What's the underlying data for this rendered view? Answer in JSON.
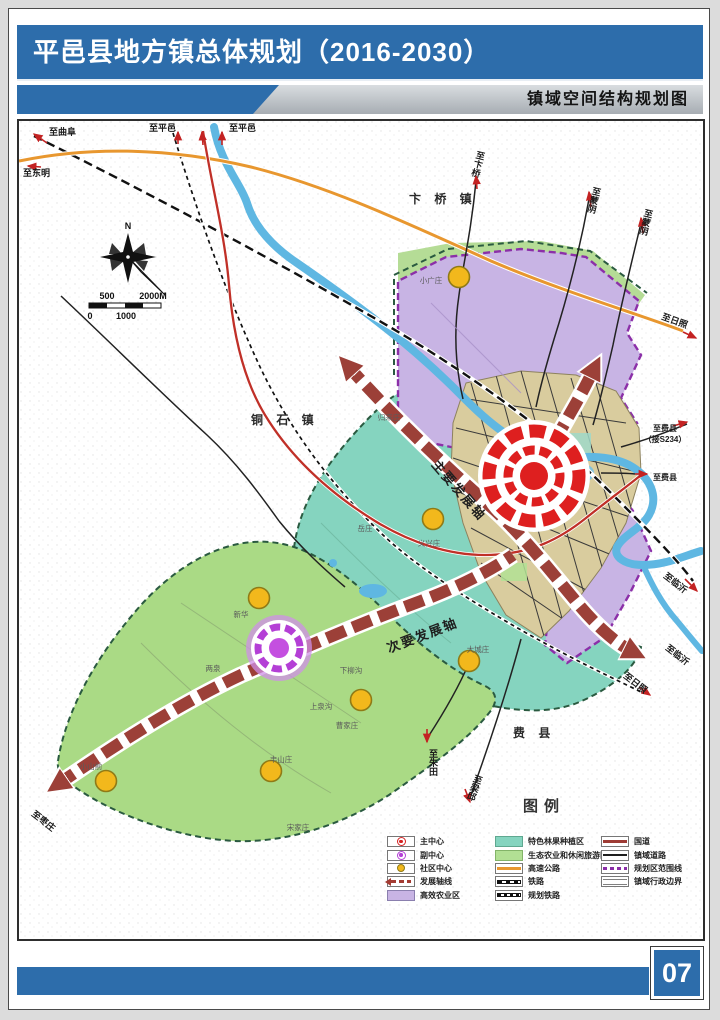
{
  "header": {
    "title": "平邑县地方镇总体规划（2016-2030）",
    "subtitle": "镇域空间结构规划图"
  },
  "map": {
    "region_labels": {
      "bianqiao": "卞 桥 镇",
      "tongshi": "铜 石 镇",
      "feixian": "费 县"
    },
    "axis_labels": {
      "main": "主要发展轴",
      "secondary": "次要发展轴"
    },
    "road_labels": {
      "to_qufu": "至曲阜",
      "to_dongming": "至东明",
      "to_pingyi_a": "至平邑",
      "to_pingyi_b": "至平邑",
      "to_bianqiao": "至卞桥",
      "to_mengyin_a": "至蒙阴",
      "to_mengyin_b": "至蒙阴",
      "to_rizhao_expressway": "至日照",
      "to_feixian_main": "至费县",
      "to_feixian_note": "（接S234）",
      "to_feixian_south": "至费县",
      "to_linyi_rail": "至临沂",
      "to_linyi_axis": "至临沂",
      "to_rizhao_rail": "至日照",
      "to_zhutian": "至朱田",
      "to_liangqiu": "至梁邱",
      "to_zaozhuang": "至枣庄"
    },
    "village_labels": {
      "xiaoguangzhuang": "小广庄",
      "guilaizhuang": "归来庄",
      "yixingzhuang": "义兴庄",
      "yuezhuang": "岳庄",
      "xinhua": "新华",
      "liangquan": "两泉",
      "xialiugou": "下柳沟",
      "dachengzhuang": "大城庄",
      "shangquangou": "上泉沟",
      "caojiazhuang": "曹家庄",
      "fengshanzhuang": "丰山庄",
      "xiaoshanqian": "小山前",
      "songjiazhuang": "宋家庄"
    },
    "compass_north": "N",
    "scale_bar": {
      "v500": "500",
      "v2000": "2000M",
      "v0": "0",
      "v1000": "1000"
    }
  },
  "legend": {
    "title": "图例",
    "col1": [
      {
        "label": "主中心"
      },
      {
        "label": "副中心"
      },
      {
        "label": "社区中心"
      },
      {
        "label": "发展轴线"
      },
      {
        "label": "高效农业区"
      }
    ],
    "col2": [
      {
        "label": "特色林果种植区"
      },
      {
        "label": "生态农业和休闲旅游区"
      },
      {
        "label": "高速公路"
      },
      {
        "label": "铁路"
      },
      {
        "label": "规划铁路"
      }
    ],
    "col3": [
      {
        "label": "国道"
      },
      {
        "label": "镇域道路"
      },
      {
        "label": "规划区范围线"
      },
      {
        "label": "镇域行政边界"
      }
    ]
  },
  "footer": {
    "page_number": "07"
  },
  "colors": {
    "header_blue": "#2d6dab",
    "axis_red": "#9c4038",
    "main_center_red": "#de1f1f",
    "sub_center_purple": "#b43fd6",
    "community_yellow": "#f2b81c",
    "zone_purple": "#c8b4e4",
    "zone_teal": "#85d4bf",
    "zone_green": "#aada85",
    "expressway_orange": "#e8972f",
    "national_road_red": "#c03028",
    "river_blue": "#5fb7e2",
    "boundary_purple": "#8b2fa8"
  }
}
